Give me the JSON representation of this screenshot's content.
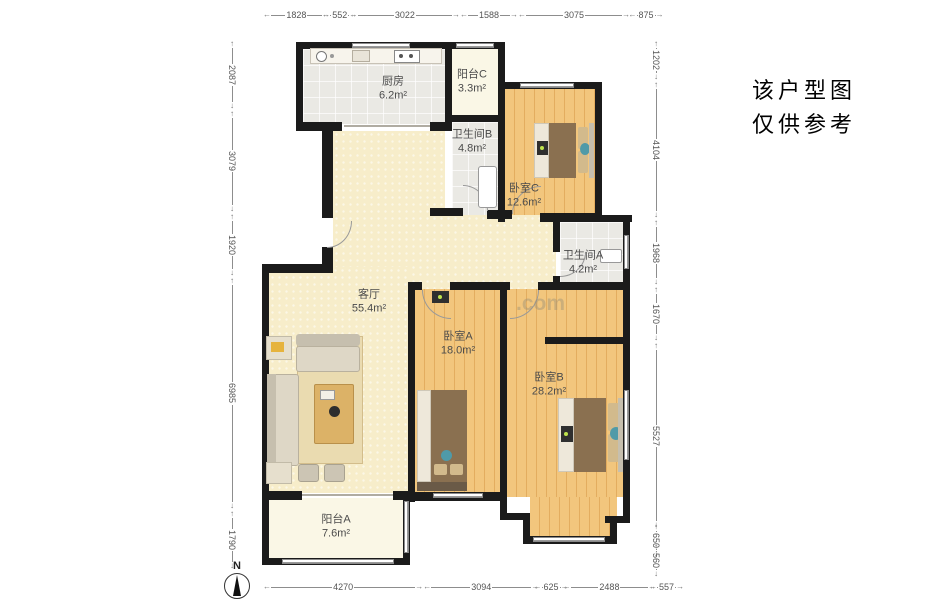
{
  "notice": {
    "line1": "该户型图",
    "line2": "仅供参考"
  },
  "compass": {
    "label": "N"
  },
  "watermark": {
    "text": ".com"
  },
  "rooms": [
    {
      "id": "kitchen",
      "name": "厨房",
      "area": "6.2m²"
    },
    {
      "id": "balcony-c",
      "name": "阳台C",
      "area": "3.3m²"
    },
    {
      "id": "bath-b",
      "name": "卫生间B",
      "area": "4.8m²"
    },
    {
      "id": "bedroom-c",
      "name": "卧室C",
      "area": "12.6m²"
    },
    {
      "id": "bath-a",
      "name": "卫生间A",
      "area": "4.2m²"
    },
    {
      "id": "living",
      "name": "客厅",
      "area": "55.4m²"
    },
    {
      "id": "bedroom-a",
      "name": "卧室A",
      "area": "18.0m²"
    },
    {
      "id": "bedroom-b",
      "name": "卧室B",
      "area": "28.2m²"
    },
    {
      "id": "balcony-a",
      "name": "阳台A",
      "area": "7.6m²"
    }
  ],
  "dimensions": {
    "top": [
      1828,
      552,
      3022,
      1588,
      3075,
      875
    ],
    "left": [
      2087,
      3079,
      1920,
      6985,
      1790
    ],
    "right": [
      1202,
      4104,
      1968,
      1670,
      5527,
      650,
      560
    ],
    "bottom": [
      4270,
      3094,
      625,
      2488,
      557
    ]
  },
  "colors": {
    "wall": "#1b1b1b",
    "wood_floor": "#f2c67d",
    "living_floor": "#f7edca",
    "tile_floor": "#eae9e4",
    "balcony_floor": "#faf7e6",
    "blanket": "#8a7050",
    "accent_teal": "#4f9aa8"
  }
}
